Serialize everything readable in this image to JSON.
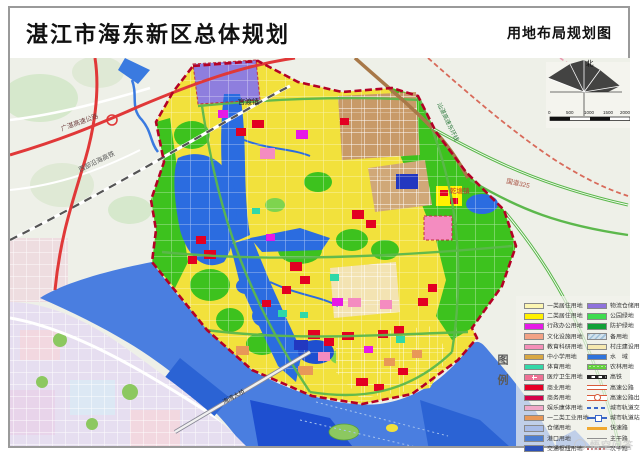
{
  "header": {
    "title": "湛江市海东新区总体规划",
    "subtitle": "用地布局规划图"
  },
  "compass": {
    "north_label": "北"
  },
  "scale_bar": {
    "ticks": [
      "0",
      "500",
      "1000",
      "1500"
    ],
    "unit_label": "2000m"
  },
  "legend": {
    "title": "图例",
    "left": [
      {
        "label": "一类居住用地",
        "color": "#fcf6b2"
      },
      {
        "label": "二类居住用地",
        "color": "#fff100"
      },
      {
        "label": "行政办公用地",
        "color": "#e619e6"
      },
      {
        "label": "文化设施用地",
        "color": "#f2a285"
      },
      {
        "label": "教育科研用地",
        "color": "#f490b8"
      },
      {
        "label": "中小学用地",
        "color": "#d8a844"
      },
      {
        "label": "体育用地",
        "color": "#35d8a8"
      },
      {
        "label": "医疗卫生用地",
        "color": "#ee7194",
        "symbol": "cross"
      },
      {
        "label": "商业用地",
        "color": "#e60026"
      },
      {
        "label": "商务用地",
        "color": "#d4004a"
      },
      {
        "label": "娱乐康体用地",
        "color": "#f2a8c8"
      },
      {
        "label": "一二类工业用地",
        "color": "#e89858"
      },
      {
        "label": "仓储用地",
        "color": "#a8bce8"
      },
      {
        "label": "港口用地",
        "color": "#4e7ed0"
      },
      {
        "label": "交通枢纽用地",
        "color": "#2b50b8"
      }
    ],
    "right": [
      {
        "label": "物流仓储用地",
        "color": "#8f72dc"
      },
      {
        "label": "公园绿地",
        "color": "#3fdc50"
      },
      {
        "label": "防护绿地",
        "color": "#12a038"
      },
      {
        "label": "备用地",
        "color": "#d2e2ec",
        "symbol": "hatch"
      },
      {
        "label": "村庄建设用地",
        "color": "#f6e9b0"
      },
      {
        "label": "水　域",
        "color": "#2f74dd"
      },
      {
        "label": "农林用地",
        "color": "#63d23c",
        "symbol": "dots"
      },
      {
        "label": "高铁",
        "color": "#222222",
        "symbol": "rail"
      },
      {
        "label": "高速公路",
        "color": "#d85a3a",
        "symbol": "double-line"
      },
      {
        "label": "高速公路出入口",
        "color": "#d85a3a",
        "symbol": "interchange"
      },
      {
        "label": "城市轨道交通线",
        "color": "#3a66c8",
        "symbol": "dash"
      },
      {
        "label": "城市轨道站点",
        "color": "#3a66c8",
        "symbol": "station"
      },
      {
        "label": "快速路",
        "color": "#f0a830",
        "symbol": "line"
      },
      {
        "label": "主干路",
        "color": "#909090",
        "symbol": "line-thin"
      },
      {
        "label": "次干路",
        "color": "#c06060",
        "symbol": "dot-red"
      }
    ]
  },
  "map_labels": {
    "expressway_gz": "广湛高速公路",
    "coastal_hsr": "西部沿海高铁",
    "east_ring_expressway": "汕湛高速东环线",
    "national_road": "国道325",
    "town_guandu": "官渡镇",
    "town_qiantang": "乾塘镇",
    "bay_bridge": "海湾大桥"
  },
  "watermark": "悟空问答",
  "colors": {
    "boundary": "#b40125",
    "water": "#2b6ce0",
    "deep_water": "#1e4fd0",
    "residential_yellow": "#f2e13c",
    "park_green": "#3dc21e",
    "logistics_purple": "#8e7ede",
    "expressway_red": "#e03838",
    "background": "#eef0e8",
    "old_city": "#e6def0"
  }
}
